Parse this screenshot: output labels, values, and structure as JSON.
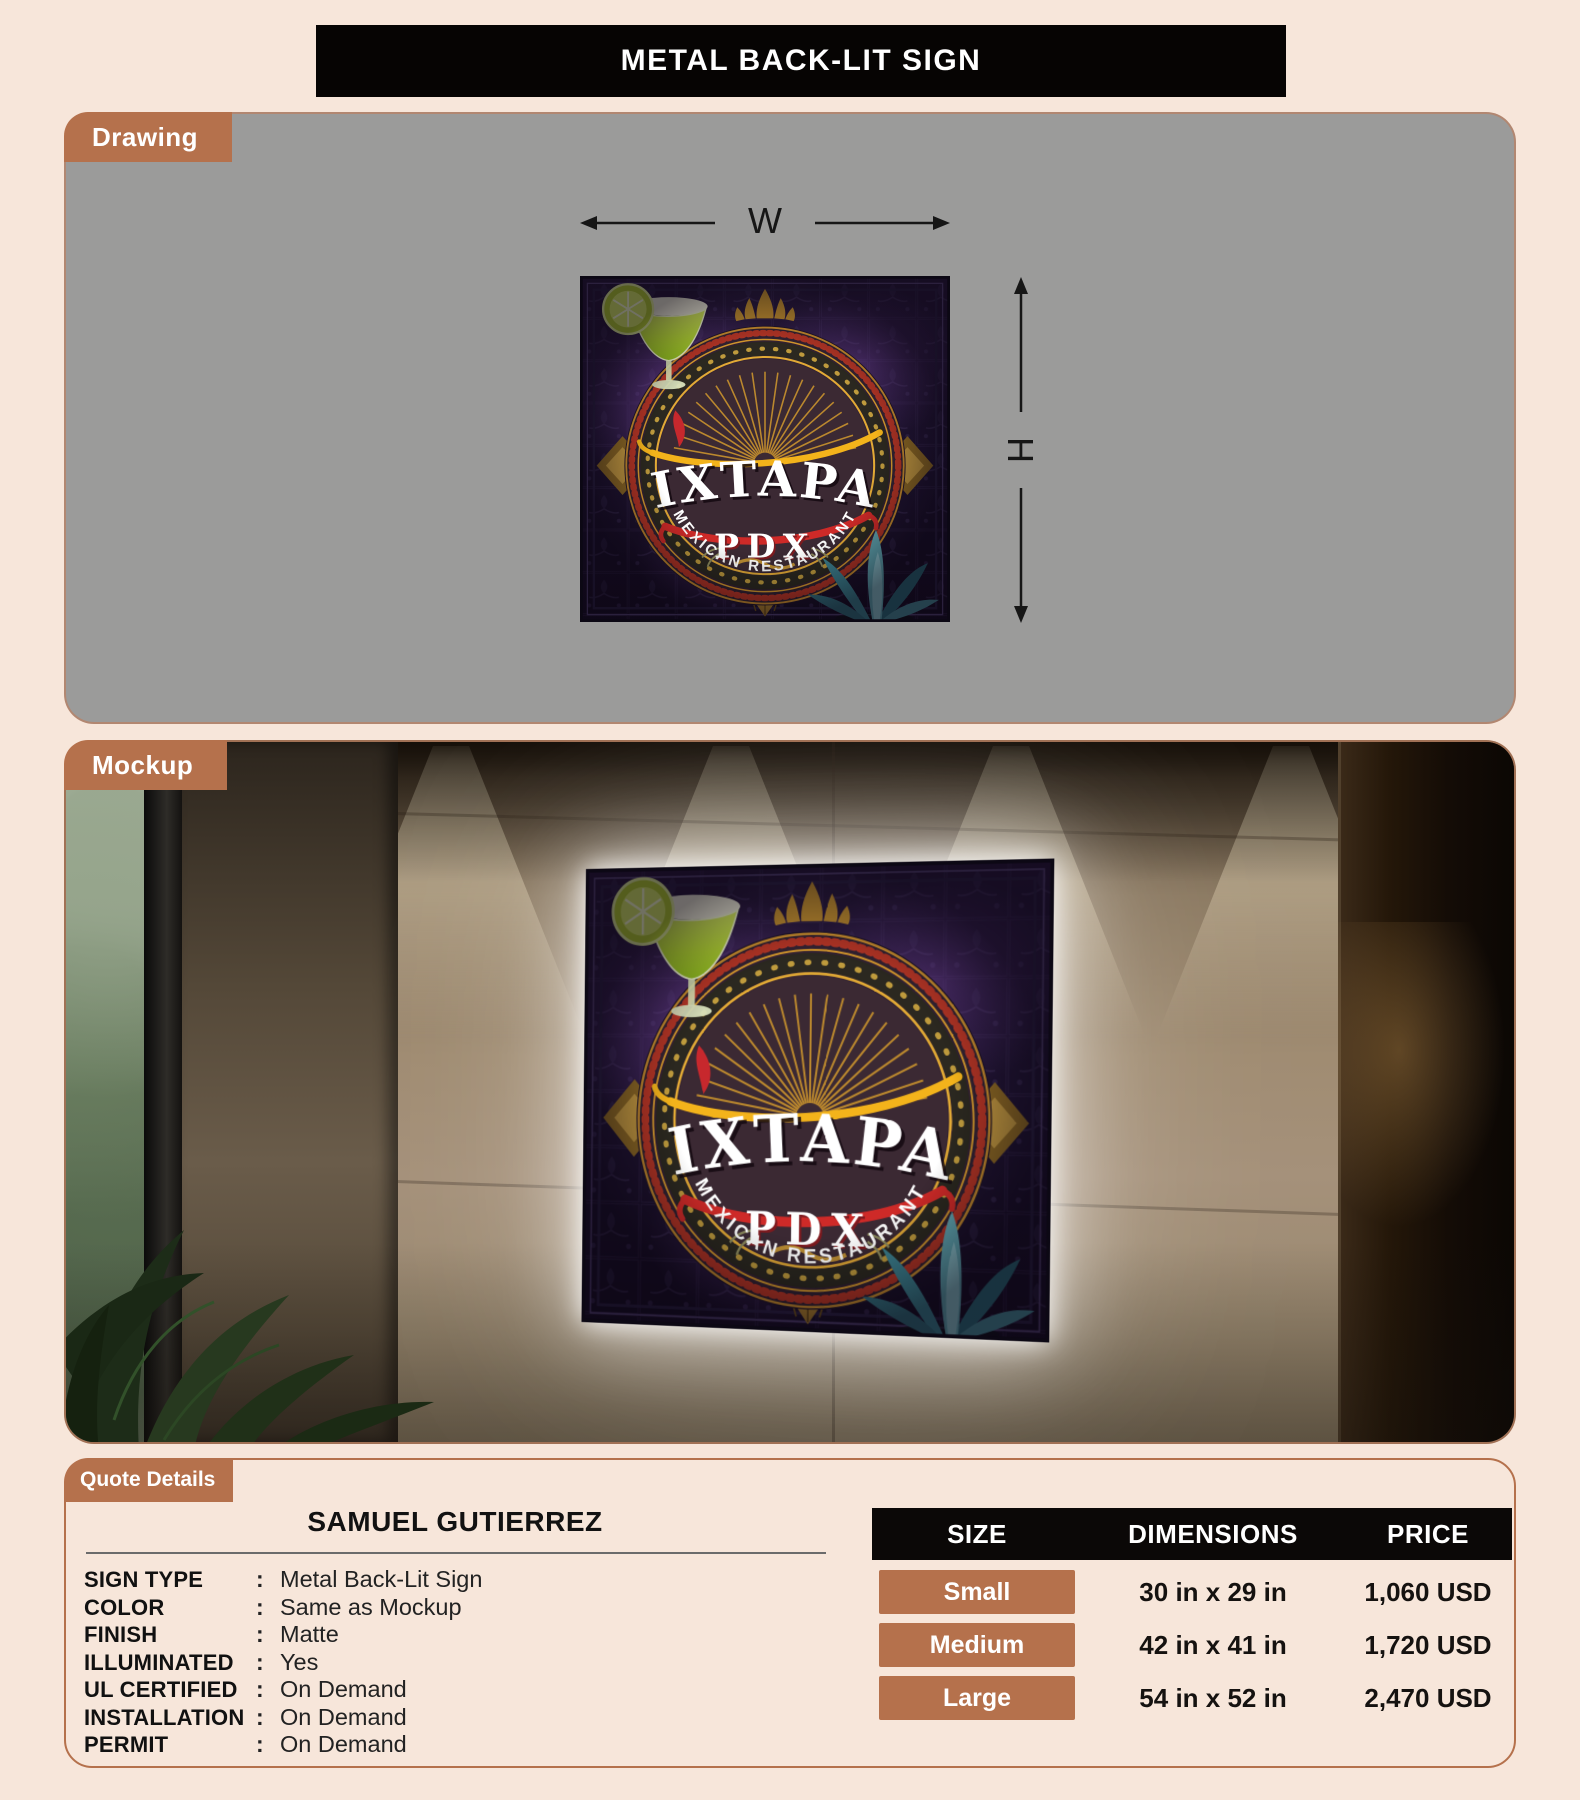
{
  "title": "METAL BACK-LIT SIGN",
  "tabs": {
    "drawing": "Drawing",
    "mockup": "Mockup",
    "quote": "Quote Details"
  },
  "dimensions": {
    "width_label": "W",
    "height_label": "H"
  },
  "sign": {
    "brand": "IXTAPA",
    "city": "PDX",
    "tagline": "MEXICAN RESTAURANT"
  },
  "quote": {
    "customer": "SAMUEL GUTIERREZ",
    "separator": ":",
    "specs": [
      {
        "label": "SIGN TYPE",
        "value": "Metal Back-Lit Sign"
      },
      {
        "label": "COLOR",
        "value": "Same as Mockup"
      },
      {
        "label": "FINISH",
        "value": "Matte"
      },
      {
        "label": "ILLUMINATED",
        "value": "Yes"
      },
      {
        "label": "UL CERTIFIED",
        "value": "On Demand"
      },
      {
        "label": "INSTALLATION",
        "value": "On Demand"
      },
      {
        "label": "PERMIT",
        "value": "On Demand"
      }
    ],
    "pricing": {
      "headers": [
        "SIZE",
        "DIMENSIONS",
        "PRICE"
      ],
      "rows": [
        {
          "size": "Small",
          "dimensions": "30 in x 29 in",
          "price": "1,060 USD"
        },
        {
          "size": "Medium",
          "dimensions": "42 in x 41 in",
          "price": "1,720 USD"
        },
        {
          "size": "Large",
          "dimensions": "54 in x 52 in",
          "price": "2,470 USD"
        }
      ]
    }
  },
  "colors": {
    "accent": "#b5714c",
    "page_bg": "#f7e6da",
    "drawing_bg": "#9b9b9a",
    "table_header_bg": "#0b0807",
    "text": "#151210"
  }
}
